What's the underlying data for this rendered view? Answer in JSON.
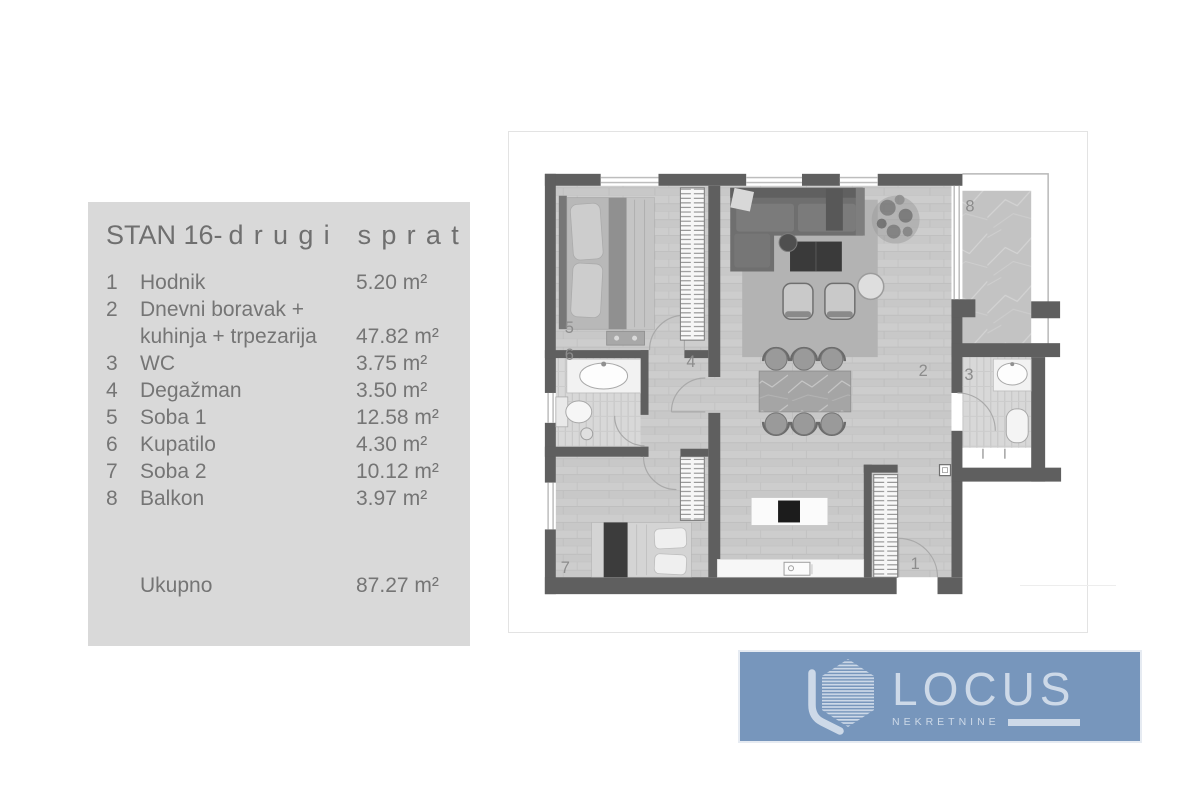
{
  "panel": {
    "title": {
      "part1": "STAN 16-",
      "part2": "drugi sprat"
    },
    "rows": [
      {
        "num": "1",
        "name": "Hodnik",
        "area": "5.20 m²"
      },
      {
        "num": "2",
        "name": "Dnevni boravak + kuhinja + trpezarija",
        "area": "47.82 m²"
      },
      {
        "num": "3",
        "name": "WC",
        "area": "3.75 m²"
      },
      {
        "num": "4",
        "name": "Degažman",
        "area": "3.50 m²"
      },
      {
        "num": "5",
        "name": "Soba 1",
        "area": "12.58 m²"
      },
      {
        "num": "6",
        "name": "Kupatilo",
        "area": "4.30 m²"
      },
      {
        "num": "7",
        "name": "Soba 2",
        "area": "10.12 m²"
      },
      {
        "num": "8",
        "name": "Balkon",
        "area": "3.97 m²"
      }
    ],
    "total": {
      "label": "Ukupno",
      "area": "87.27 m²"
    }
  },
  "floorplan": {
    "labels": {
      "hodnik": "1",
      "living": "2",
      "wc": "3",
      "degazman": "4",
      "soba1": "5",
      "kupatilo": "6",
      "soba2": "7",
      "balkon": "8"
    }
  },
  "logo": {
    "brand": "LOCUS",
    "subtitle": "NEKRETNINE",
    "colors": {
      "background": "#7796bc",
      "foreground": "#cdd9e8"
    }
  },
  "colors": {
    "panel_bg": "#d9d9d9",
    "panel_text": "#757575",
    "wall": "#5f5f5f",
    "floor": "#c8c8c8",
    "room_label": "#8c8c8c"
  }
}
